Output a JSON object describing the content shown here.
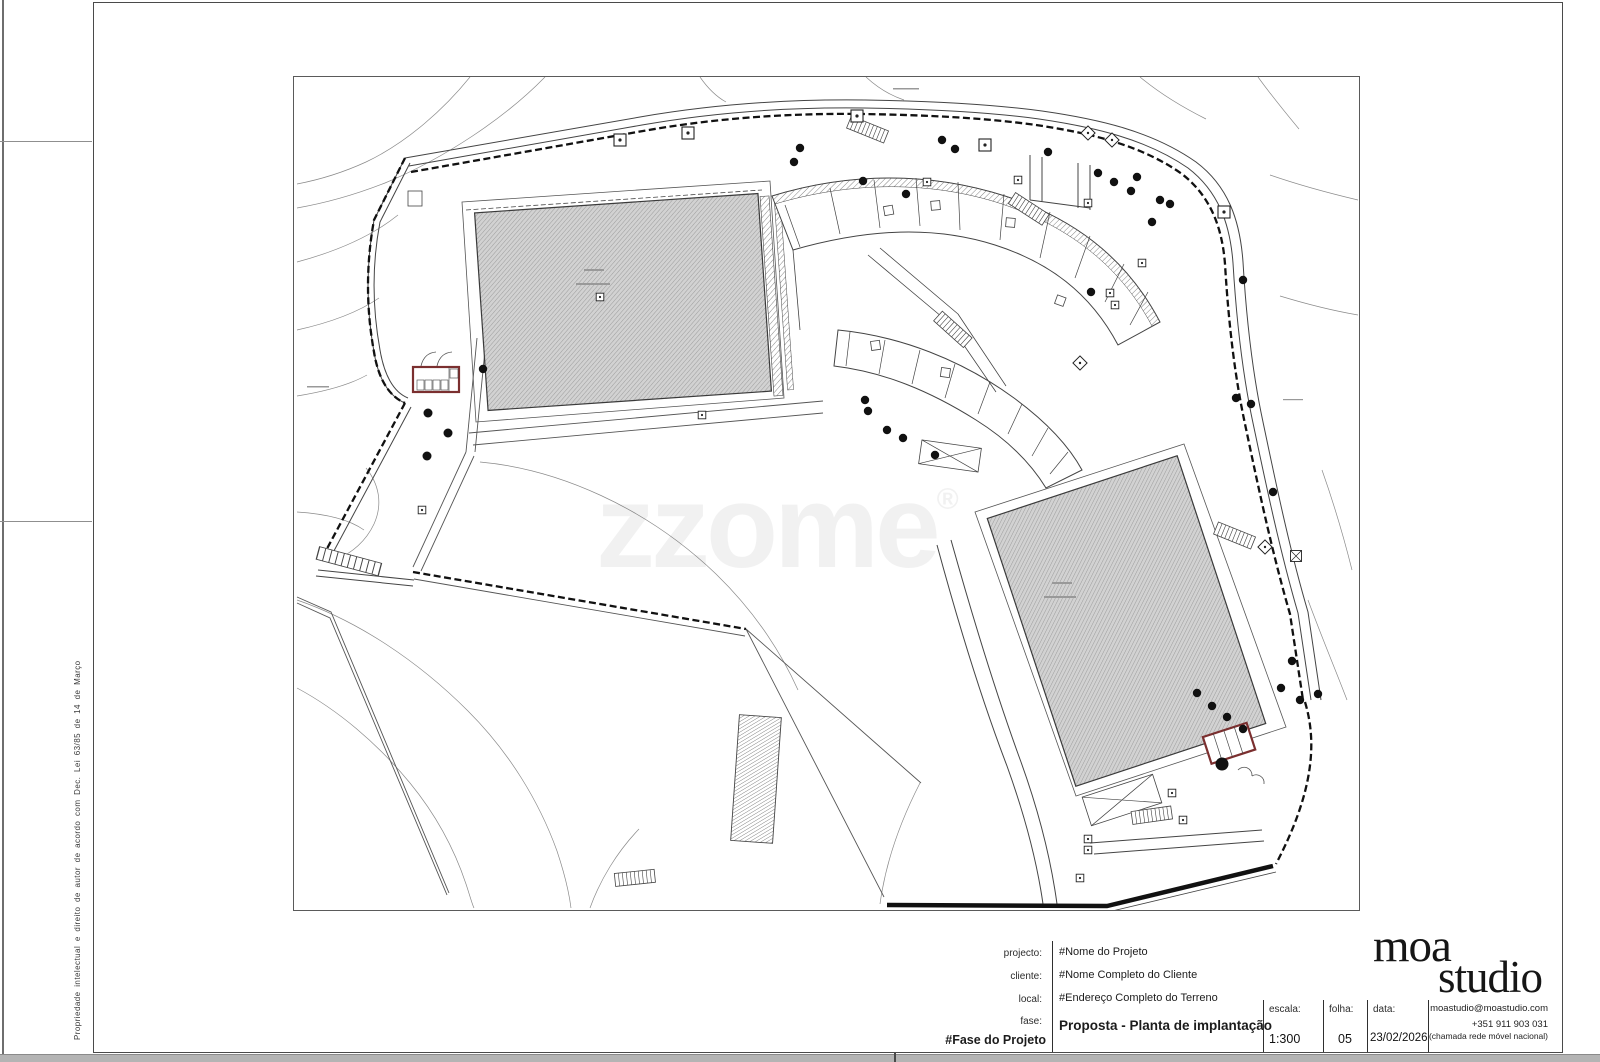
{
  "sheet": {
    "copyright_notice": "Propriedade intelectual e direito de autor de acordo com Dec. Lei 63/85 de 14 de Março",
    "watermark": "zzome",
    "watermark_reg": "®"
  },
  "title_block": {
    "project_label": "projecto:",
    "project_value": "#Nome do Projeto",
    "client_label": "cliente:",
    "client_value": "#Nome Completo do Cliente",
    "site_label": "local:",
    "site_value": "#Endereço Completo do Terreno",
    "phase_label": "fase:",
    "phase_value": "#Fase do Projeto",
    "drawing_title": "Proposta - Planta de implantação",
    "scale_label": "escala:",
    "scale_value": "1:300",
    "sheet_label": "folha:",
    "sheet_value": "05",
    "date_label": "data:",
    "date_value": "23/02/2026"
  },
  "logo": {
    "line1": "moa",
    "line2": "studio",
    "email": "moastudio@moastudio.com",
    "phone": "+351 911 903 031",
    "phone_note": "(chamada rede móvel nacional)"
  },
  "colors": {
    "line": "#3a3a3a",
    "building_fill": "#d2d2d2",
    "annex_outline": "#7b2f2f",
    "page_edge": "#b4b4b4"
  }
}
